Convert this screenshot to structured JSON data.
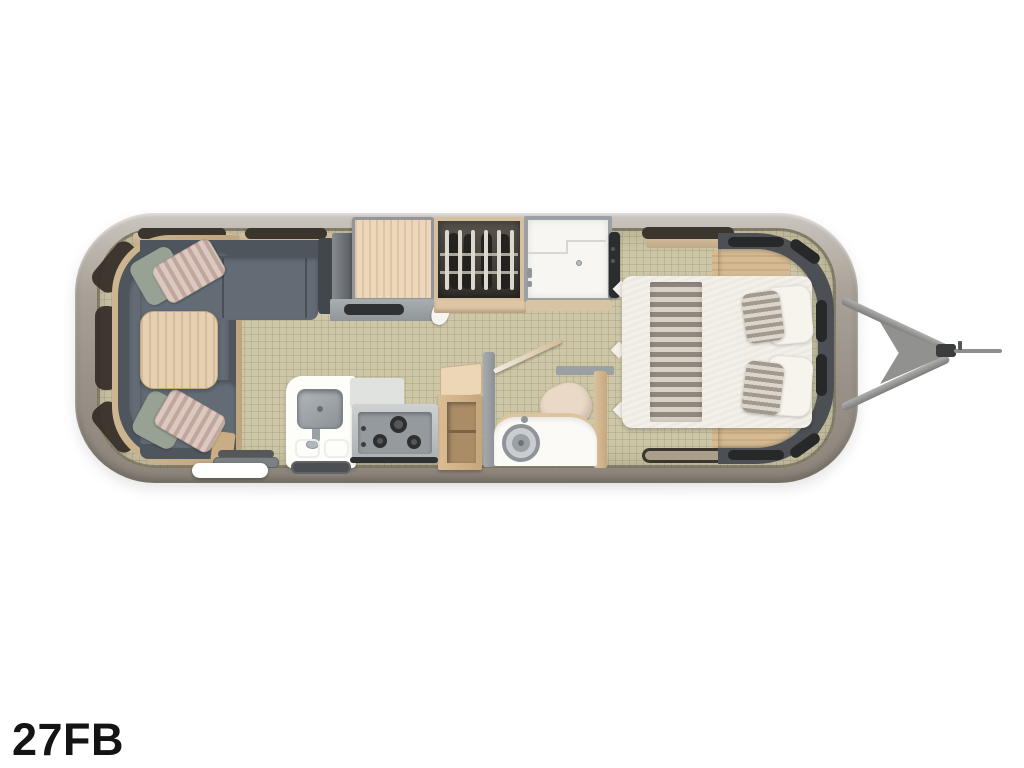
{
  "page": {
    "background_color": "#ffffff"
  },
  "floorplan": {
    "model_label": "27FB",
    "diagram_type": "travel-trailer-floor-plan",
    "orientation": "hitch-on-right",
    "colors": {
      "shell": "#a8a197",
      "shell_light": "#cac5be",
      "shell_dark": "#8d857b",
      "floor": "#cdc7a7",
      "wall_gray": "#9aa0a4",
      "window_dark": "#352f28",
      "sofa_back": "#4e555c",
      "sofa_seat": "#636c75",
      "wood_light": "#ecd7bb",
      "wood_mid": "#d5ba92",
      "wood_table": "#e6d0b2",
      "pillow_green": "#97a295",
      "pillow_stripe_a": "#dcc8bf",
      "pillow_stripe_b": "#bfa79e",
      "bed_duvet": "#f2f0e8",
      "bed_stripe_a": "#90887f",
      "bed_stripe_b": "#d8d1c6",
      "appliance_dark": "#2f3133",
      "hitch_gray": "#919190"
    },
    "features": [
      {
        "name": "wraparound-lounge-sofa"
      },
      {
        "name": "dinette-table"
      },
      {
        "name": "pantry-cabinet"
      },
      {
        "name": "wardrobe-closet"
      },
      {
        "name": "shower-room"
      },
      {
        "name": "kitchen-sink"
      },
      {
        "name": "cooktop-stove"
      },
      {
        "name": "island-cabinet"
      },
      {
        "name": "toilet"
      },
      {
        "name": "vanity-sink"
      },
      {
        "name": "front-queen-bed"
      },
      {
        "name": "entry-step"
      },
      {
        "name": "hitch-tongue"
      }
    ]
  }
}
